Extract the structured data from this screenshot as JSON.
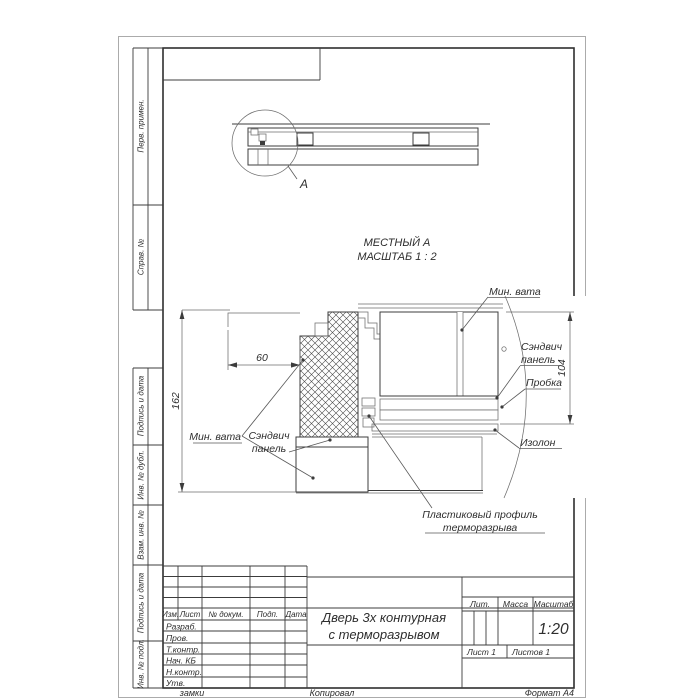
{
  "colors": {
    "paper": "#ffffff",
    "main_line": "#3c3c3c",
    "thin_line": "#6e6e6e",
    "hatch_line": "#4a4a4a"
  },
  "margin_column": {
    "labels": [
      "Перв. примен.",
      "Справ. №",
      "Подпись и дата",
      "Инв. № дубл.",
      "Взам. инв. №",
      "Подпись и дата",
      "Инв. № подл."
    ]
  },
  "overview": {
    "detail_marker": "А"
  },
  "detail_view": {
    "caption_line1": "МЕСТНЫЙ А",
    "caption_line2": "МАСШТАБ 1 : 2",
    "dim_width": "60",
    "dim_height": "162",
    "dim_leaf": "104",
    "labels": {
      "mineral_wool_left": "Мин. вата",
      "sandwich_left_1": "Сэндвич",
      "sandwich_left_2": "панель",
      "mineral_wool_right": "Мин. вата",
      "sandwich_right_1": "Сэндвич",
      "sandwich_right_2": "панель",
      "cork": "Пробка",
      "izolon": "Изолон",
      "plastic_1": "Пластиковый профиль",
      "plastic_2": "терморазрыва"
    }
  },
  "title_block": {
    "columns": {
      "izm": "Изм.",
      "list": "Лист",
      "doc": "№ докум.",
      "podp": "Подп.",
      "data": "Дата"
    },
    "rows": [
      "Разраб.",
      "Пров.",
      "Т.контр.",
      "Нач. КБ",
      "Н.контр.",
      "Утв."
    ],
    "title_line1": "Дверь 3х контурная",
    "title_line2": "с терморазрывом",
    "lit_label": "Лит.",
    "mass_label": "Масса",
    "scale_label": "Масштаб",
    "scale_value": "1:20",
    "sheet_label": "Лист 1",
    "sheets_label": "Листов 1"
  },
  "footer": {
    "left": "замки",
    "center": "Копировал",
    "right": "Формат А4"
  }
}
